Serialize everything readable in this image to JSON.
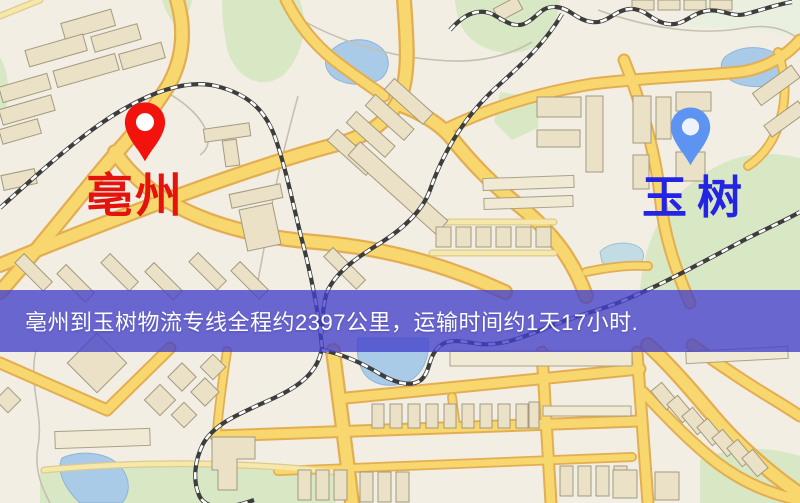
{
  "map": {
    "markers": [
      {
        "id": "origin",
        "label": "亳州",
        "pin_icon": "map-pin-icon",
        "pin_color": "#f2140c",
        "label_color": "#e4130d"
      },
      {
        "id": "destination",
        "label": "玉树",
        "pin_icon": "map-pin-icon",
        "pin_color": "#5d94f2",
        "label_color": "#2424e4"
      }
    ],
    "banner": {
      "text": "亳州到玉树物流专线全程约2397公里，运输时间约1天17小时.",
      "background_color": "#4340cb",
      "text_color": "#ffffff"
    },
    "route": {
      "from": "亳州",
      "to": "玉树",
      "distance_km": "2397",
      "duration": "1天17小时"
    },
    "colors": {
      "background": "#f3eee3",
      "road_fill": "#f7d76e",
      "road_casing": "#e3ae52",
      "railway": "#3d3d3d",
      "water": "#a9cbe8",
      "park": "#d8e8c4"
    }
  }
}
